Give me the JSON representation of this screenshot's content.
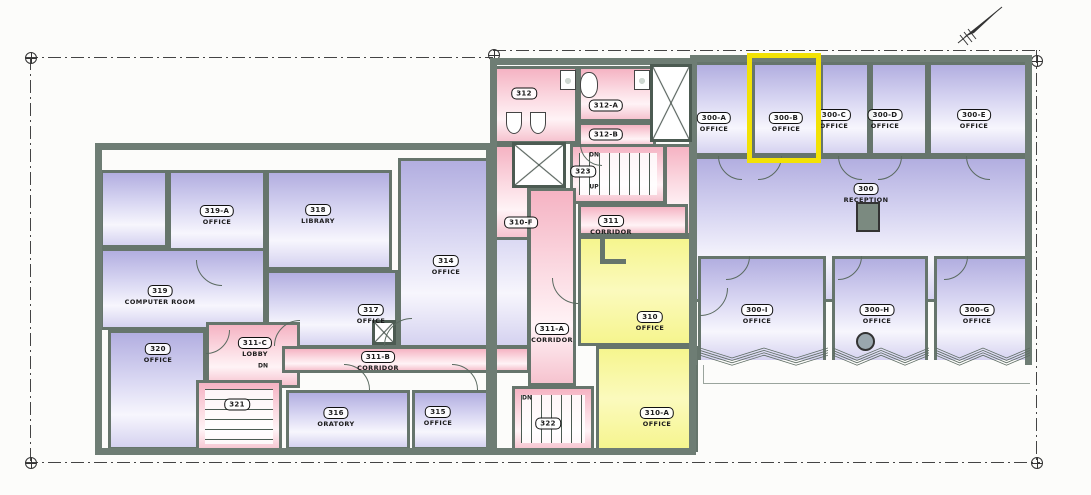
{
  "colors": {
    "wall": "#6E7D74",
    "purple": "#BDB9E6",
    "pink": "#F7BFCB",
    "yellow": "#F8F79B",
    "highlight": "#F2E205"
  },
  "highlight": {
    "x": 747,
    "y": 53,
    "w": 74,
    "h": 110,
    "room": "300-B"
  },
  "rooms": [
    {
      "id": "300",
      "name": "RECEPTION",
      "fill": "purple",
      "x": 694,
      "y": 156,
      "w": 334,
      "h": 146,
      "lx": 866,
      "ly": 190
    },
    {
      "id": "300-A",
      "name": "OFFICE",
      "fill": "purple",
      "x": 694,
      "y": 62,
      "w": 58,
      "h": 94,
      "lx": 714,
      "ly": 119
    },
    {
      "id": "300-B",
      "name": "OFFICE",
      "fill": "purple",
      "x": 752,
      "y": 62,
      "w": 68,
      "h": 94,
      "lx": 786,
      "ly": 119
    },
    {
      "id": "300-C",
      "name": "OFFICE",
      "fill": "purple",
      "x": 820,
      "y": 62,
      "w": 50,
      "h": 94,
      "lx": 834,
      "ly": 116
    },
    {
      "id": "300-D",
      "name": "OFFICE",
      "fill": "purple",
      "x": 870,
      "y": 62,
      "w": 58,
      "h": 94,
      "lx": 885,
      "ly": 116
    },
    {
      "id": "300-E",
      "name": "OFFICE",
      "fill": "purple",
      "x": 928,
      "y": 62,
      "w": 100,
      "h": 94,
      "lx": 974,
      "ly": 116
    },
    {
      "id": "300-I",
      "name": "OFFICE",
      "fill": "purple",
      "nb": true,
      "x": 698,
      "y": 256,
      "w": 128,
      "h": 104,
      "lx": 757,
      "ly": 311
    },
    {
      "id": "300-H",
      "name": "OFFICE",
      "fill": "purple",
      "nb": true,
      "x": 832,
      "y": 256,
      "w": 96,
      "h": 104,
      "lx": 877,
      "ly": 311
    },
    {
      "id": "300-G",
      "name": "OFFICE",
      "fill": "purple",
      "nb": true,
      "x": 934,
      "y": 256,
      "w": 94,
      "h": 104,
      "lx": 977,
      "ly": 311
    },
    {
      "id": "",
      "name": "",
      "fill": "purple",
      "x": 100,
      "y": 170,
      "w": 68,
      "h": 78
    },
    {
      "id": "319-A",
      "name": "OFFICE",
      "fill": "purple",
      "x": 168,
      "y": 170,
      "w": 98,
      "h": 90,
      "lx": 217,
      "ly": 212
    },
    {
      "id": "318",
      "name": "LIBRARY",
      "fill": "purple",
      "x": 266,
      "y": 170,
      "w": 126,
      "h": 100,
      "lx": 318,
      "ly": 211
    },
    {
      "id": "319",
      "name": "COMPUTER ROOM",
      "fill": "purple",
      "x": 100,
      "y": 248,
      "w": 166,
      "h": 82,
      "lx": 160,
      "ly": 292
    },
    {
      "id": "320",
      "name": "OFFICE",
      "fill": "purple",
      "x": 108,
      "y": 330,
      "w": 98,
      "h": 120,
      "lx": 158,
      "ly": 350
    },
    {
      "id": "317",
      "name": "OFFICE",
      "fill": "purple",
      "x": 266,
      "y": 270,
      "w": 132,
      "h": 78,
      "lx": 371,
      "ly": 311
    },
    {
      "id": "314",
      "name": "OFFICE",
      "fill": "purple",
      "x": 398,
      "y": 158,
      "w": 132,
      "h": 190,
      "lx": 446,
      "ly": 262
    },
    {
      "id": "311-C",
      "name": "LOBBY",
      "fill": "pink",
      "x": 206,
      "y": 322,
      "w": 94,
      "h": 66,
      "lx": 255,
      "ly": 344
    },
    {
      "id": "311-B",
      "name": "CORRIDOR",
      "fill": "pink",
      "x": 282,
      "y": 346,
      "w": 248,
      "h": 27,
      "lx": 378,
      "ly": 358
    },
    {
      "id": "321",
      "name": "",
      "fill": "pink",
      "x": 196,
      "y": 380,
      "w": 86,
      "h": 73,
      "lx": 237,
      "ly": 401,
      "treads": "h"
    },
    {
      "id": "316",
      "name": "ORATORY",
      "fill": "purple",
      "x": 286,
      "y": 390,
      "w": 124,
      "h": 60,
      "lx": 336,
      "ly": 414
    },
    {
      "id": "315",
      "name": "OFFICE",
      "fill": "purple",
      "x": 412,
      "y": 390,
      "w": 78,
      "h": 60,
      "lx": 438,
      "ly": 413
    },
    {
      "id": "312",
      "name": "",
      "fill": "pink",
      "x": 494,
      "y": 66,
      "w": 84,
      "h": 78,
      "lx": 524,
      "ly": 90
    },
    {
      "id": "312-A",
      "name": "",
      "fill": "pink",
      "x": 578,
      "y": 66,
      "w": 78,
      "h": 56,
      "lx": 606,
      "ly": 102
    },
    {
      "id": "312-B",
      "name": "",
      "fill": "pink",
      "x": 578,
      "y": 122,
      "w": 78,
      "h": 26,
      "lx": 606,
      "ly": 131
    },
    {
      "id": "310-F",
      "name": "",
      "fill": "pink",
      "x": 494,
      "y": 144,
      "w": 36,
      "h": 96,
      "lx": 521,
      "ly": 219
    },
    {
      "id": "",
      "name": "",
      "fill": "pink",
      "x": 664,
      "y": 144,
      "w": 30,
      "h": 92
    },
    {
      "id": "323",
      "name": "",
      "fill": "pink",
      "x": 570,
      "y": 144,
      "w": 96,
      "h": 60,
      "lx": 583,
      "ly": 168,
      "treads": "v"
    },
    {
      "id": "311",
      "name": "CORRIDOR",
      "fill": "pink",
      "x": 578,
      "y": 204,
      "w": 110,
      "h": 32,
      "lx": 611,
      "ly": 222
    },
    {
      "id": "311-A",
      "name": "CORRIDOR",
      "fill": "pink",
      "x": 528,
      "y": 188,
      "w": 48,
      "h": 198,
      "lx": 552,
      "ly": 330
    },
    {
      "id": "310",
      "name": "OFFICE",
      "fill": "yellow",
      "x": 578,
      "y": 236,
      "w": 118,
      "h": 110,
      "lx": 650,
      "ly": 318
    },
    {
      "id": "310-A",
      "name": "OFFICE",
      "fill": "yellow",
      "x": 596,
      "y": 346,
      "w": 102,
      "h": 106,
      "lx": 657,
      "ly": 414
    },
    {
      "id": "322",
      "name": "",
      "fill": "pink",
      "x": 512,
      "y": 386,
      "w": 82,
      "h": 66,
      "lx": 548,
      "ly": 420,
      "treads": "v"
    }
  ],
  "shafts": [
    {
      "x": 650,
      "y": 64,
      "w": 42,
      "h": 78
    },
    {
      "x": 512,
      "y": 142,
      "w": 54,
      "h": 46
    },
    {
      "x": 372,
      "y": 320,
      "w": 24,
      "h": 25
    }
  ],
  "doors": [
    {
      "x": 222,
      "y": 260,
      "r": 26,
      "q": "sw"
    },
    {
      "x": 300,
      "y": 346,
      "r": 26,
      "q": "nw"
    },
    {
      "x": 206,
      "y": 330,
      "r": 24,
      "q": "se"
    },
    {
      "x": 412,
      "y": 346,
      "r": 28,
      "q": "nw"
    },
    {
      "x": 344,
      "y": 390,
      "r": 26,
      "q": "ne"
    },
    {
      "x": 452,
      "y": 390,
      "r": 26,
      "q": "ne"
    },
    {
      "x": 578,
      "y": 278,
      "r": 26,
      "q": "sw"
    },
    {
      "x": 700,
      "y": 288,
      "r": 28,
      "q": "se"
    },
    {
      "x": 742,
      "y": 156,
      "r": 24,
      "q": "sw"
    },
    {
      "x": 758,
      "y": 156,
      "r": 24,
      "q": "se"
    },
    {
      "x": 862,
      "y": 156,
      "r": 24,
      "q": "sw"
    },
    {
      "x": 878,
      "y": 156,
      "r": 24,
      "q": "se"
    },
    {
      "x": 990,
      "y": 156,
      "r": 24,
      "q": "sw"
    },
    {
      "x": 726,
      "y": 256,
      "r": 24,
      "q": "se"
    },
    {
      "x": 838,
      "y": 256,
      "r": 24,
      "q": "se"
    },
    {
      "x": 944,
      "y": 256,
      "r": 24,
      "q": "se"
    },
    {
      "x": 602,
      "y": 144,
      "r": 22,
      "q": "sw"
    }
  ],
  "fixtures": [
    {
      "kind": "sink",
      "x": 560,
      "y": 70,
      "w": 16,
      "h": 20
    },
    {
      "kind": "sink",
      "x": 634,
      "y": 70,
      "w": 16,
      "h": 20
    },
    {
      "kind": "urinal",
      "x": 506,
      "y": 112,
      "w": 16,
      "h": 22
    },
    {
      "kind": "urinal",
      "x": 530,
      "y": 112,
      "w": 16,
      "h": 22
    },
    {
      "kind": "toilet",
      "x": 580,
      "y": 72,
      "w": 18,
      "h": 26
    },
    {
      "kind": "reception-desk",
      "x": 856,
      "y": 202,
      "w": 24,
      "h": 30
    },
    {
      "kind": "column",
      "x": 856,
      "y": 332,
      "w": 19,
      "h": 19
    },
    {
      "kind": "wall-stub",
      "x": 600,
      "y": 238,
      "w": 5,
      "h": 26
    },
    {
      "kind": "wall-stub",
      "x": 600,
      "y": 259,
      "w": 26,
      "h": 5
    },
    {
      "kind": "terrace-line",
      "x": 703,
      "y": 383,
      "w": 327,
      "h": 1
    },
    {
      "kind": "terrace-line",
      "x": 703,
      "y": 365,
      "w": 1,
      "h": 19
    }
  ],
  "small_texts": [
    {
      "t": "DN",
      "x": 594,
      "y": 155
    },
    {
      "t": "UP",
      "x": 594,
      "y": 187
    },
    {
      "t": "DN",
      "x": 527,
      "y": 398
    },
    {
      "t": "DN",
      "x": 263,
      "y": 366
    }
  ],
  "boundaries": [
    {
      "dir": "h",
      "x": 25,
      "y": 57,
      "len": 468
    },
    {
      "dir": "h",
      "x": 493,
      "y": 50,
      "len": 547
    },
    {
      "dir": "v",
      "x": 30,
      "y": 57,
      "len": 405
    },
    {
      "dir": "v",
      "x": 1036,
      "y": 50,
      "len": 412
    },
    {
      "dir": "h",
      "x": 25,
      "y": 462,
      "len": 1015
    }
  ],
  "markers": [
    {
      "x": 30,
      "y": 57
    },
    {
      "x": 493,
      "y": 54
    },
    {
      "x": 1036,
      "y": 60
    },
    {
      "x": 30,
      "y": 462
    },
    {
      "x": 1036,
      "y": 462
    }
  ],
  "bays": [
    {
      "x": 700,
      "w": 128
    },
    {
      "x": 833,
      "w": 96
    },
    {
      "x": 936,
      "w": 94
    }
  ]
}
